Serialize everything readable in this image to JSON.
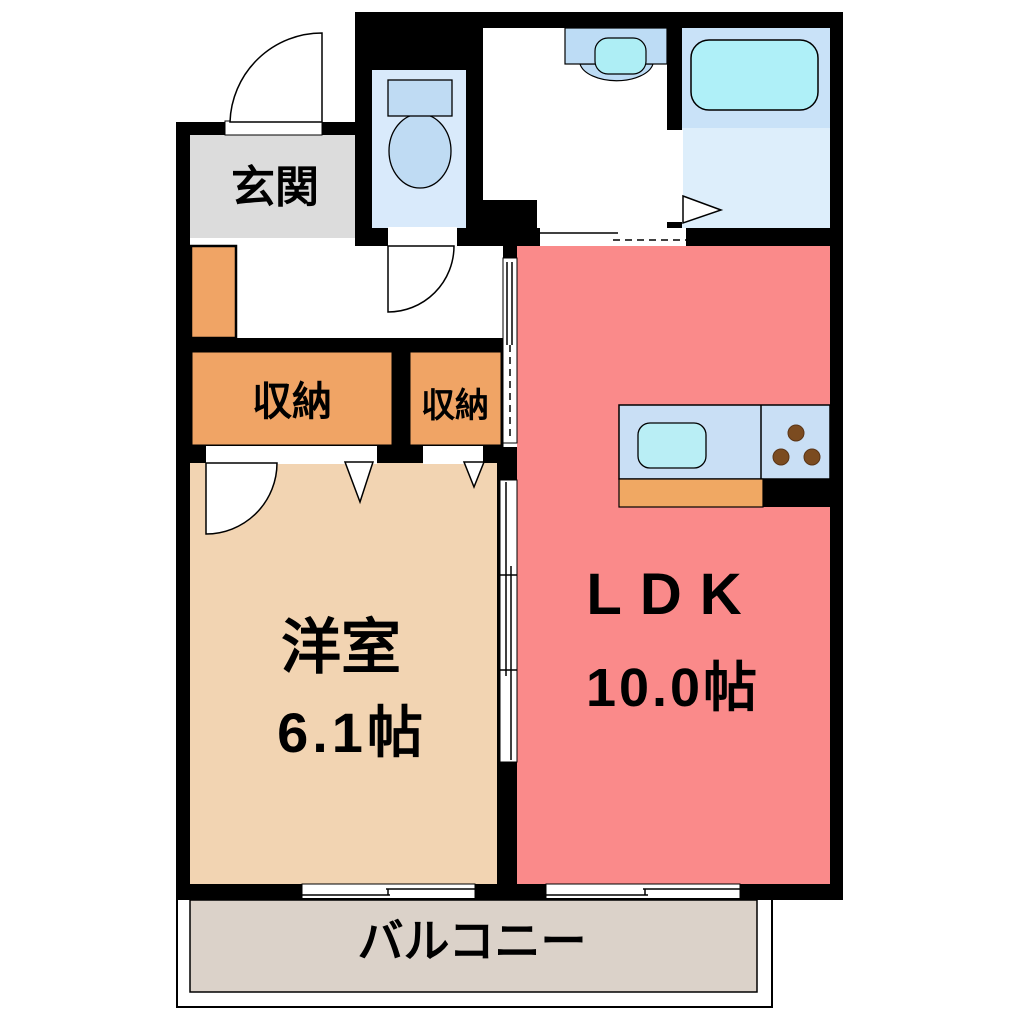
{
  "plan": {
    "type": "apartment-floor-plan",
    "rooms": {
      "entrance": {
        "label": "玄関"
      },
      "closet_hall_left": {
        "label": "収納"
      },
      "closet_hall_right": {
        "label": "収納"
      },
      "western_room": {
        "label": "洋室",
        "size": "6.1帖"
      },
      "ldk": {
        "label": "LDK",
        "size": "10.0帖"
      },
      "balcony": {
        "label": "バルコニー"
      }
    },
    "fixtures": [
      "toilet-icon",
      "washbasin-icon",
      "bathtub-icon",
      "kitchen-sink-icon",
      "stove-burners-icon"
    ],
    "colors": {
      "wall": "#000000",
      "entrance_floor": "#dcdcdc",
      "toilet_floor": "#d9eafb",
      "bath_tub_zone": "#c9e2f8",
      "bath_floor": "#ddeefb",
      "ldk_floor": "#fa8a8a",
      "western_room_floor": "#f2d4b2",
      "closet": "#f0a465",
      "kitchen_counter": "#c9dff5",
      "kitchen_cabinet": "#f0a863",
      "sink_cyan": "#b9eef5",
      "tub_cyan": "#aff0f8",
      "burner_brown": "#7b4b20",
      "balcony_floor": "#dbd2c9"
    }
  }
}
